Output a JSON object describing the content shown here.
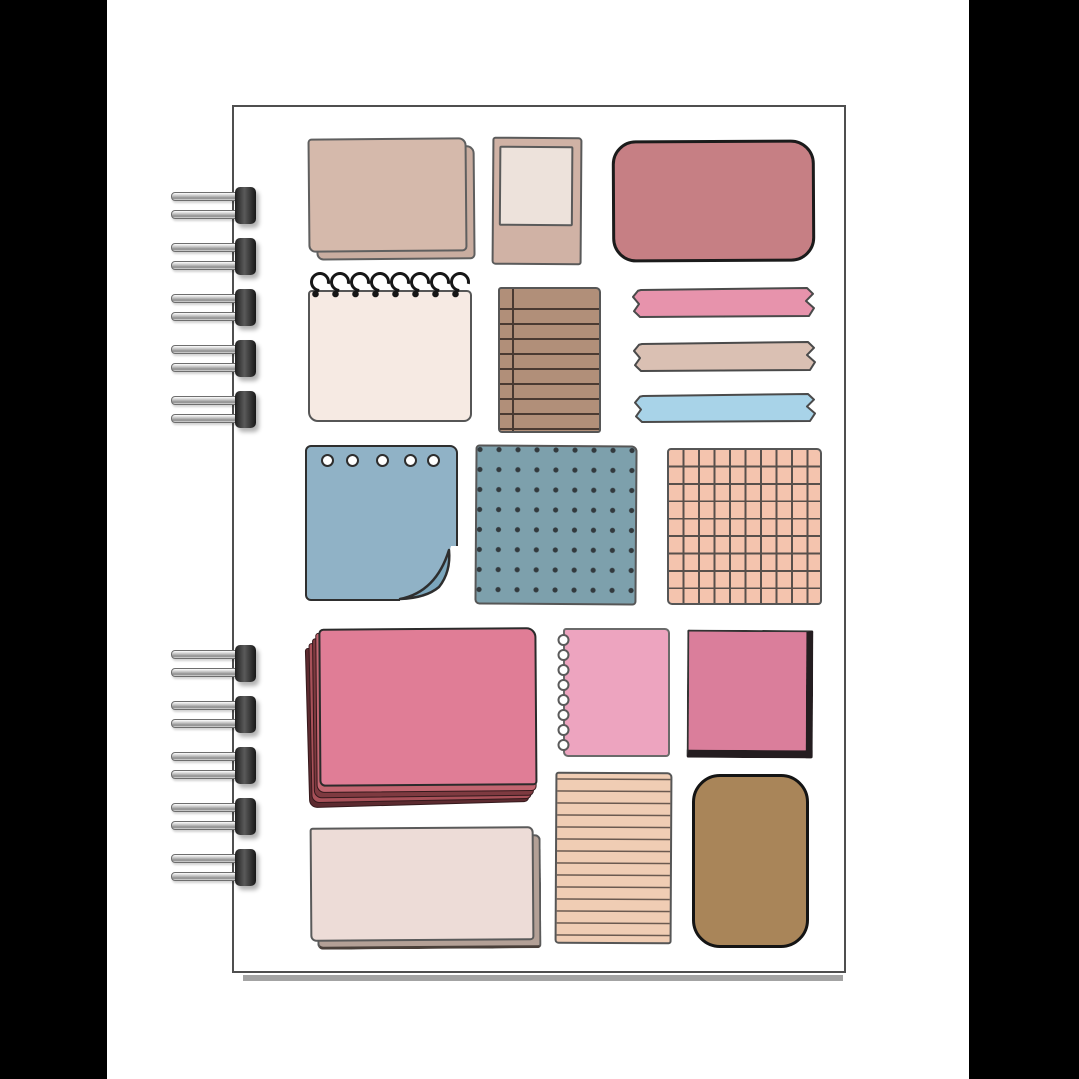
{
  "scene": {
    "subject": "spiral-bound notebook cover decorated with hand-drawn paper scraps, sticky notes and washi-tape stickers"
  },
  "canvas": {
    "width": 1079,
    "height": 1079,
    "background": "#ffffff"
  },
  "side_bars": {
    "color": "#000000",
    "left_x": 0,
    "left_width": 107,
    "right_x": 969,
    "right_width": 110
  },
  "cover": {
    "x": 232,
    "y": 105,
    "width": 614,
    "height": 868,
    "fill": "#ffffff",
    "border_color": "#4f4f4f",
    "shadow": {
      "x": 243,
      "y": 975,
      "width": 600,
      "height": 6,
      "color": "#a3a3a3"
    }
  },
  "binding": {
    "x": 171,
    "coil_width": 88,
    "top_group_centers_y": [
      205,
      256,
      307,
      358,
      409
    ],
    "bottom_group_centers_y": [
      663,
      714,
      765,
      816,
      867
    ],
    "metal_light": "#f4f4f4",
    "metal_dark": "#5e5e5e",
    "cap_color": "#2c2c2c"
  },
  "stickers": [
    {
      "name": "tan-stacked-note",
      "type": "stacked",
      "x": 308,
      "y": 138,
      "w": 159,
      "h": 114,
      "fill": "#d5b9ab",
      "back": "#c9ada0",
      "outline": "#5f5f5f",
      "dx": 8,
      "dy": 8,
      "tilt": -0.5,
      "radius": "4px 8px 5px 7px"
    },
    {
      "name": "polaroid-frame",
      "type": "polaroid",
      "x": 492,
      "y": 137,
      "w": 90,
      "h": 128,
      "frame": "#d0b2a5",
      "photo": "#ede2db",
      "outline": "#5a5a5a",
      "tilt": 0.4
    },
    {
      "name": "rose-rounded-card",
      "type": "card",
      "x": 612,
      "y": 140,
      "w": 203,
      "h": 122,
      "fill": "#c67f84",
      "outline": "#1b1b1b",
      "bw": 3,
      "radius": 24,
      "tilt": -0.3
    },
    {
      "name": "spiral-notepad",
      "type": "notepad",
      "x": 306,
      "y": 270,
      "w": 168,
      "h": 152,
      "fill": "#f6eae3",
      "outline": "#565656",
      "loop_color": "#161616",
      "loops": 8,
      "tilt": 0
    },
    {
      "name": "brown-lined-note",
      "type": "hlines",
      "x": 498,
      "y": 287,
      "w": 103,
      "h": 146,
      "fill": "#b18f79",
      "line": "#4a3a32",
      "gap": 15,
      "lw": 2,
      "margin": 12,
      "outline": "#565656",
      "tilt": 0
    },
    {
      "name": "washi-tape-pink",
      "type": "tape",
      "x": 630,
      "y": 287,
      "w": 187,
      "h": 31,
      "fill": "#e793ac",
      "outline": "#4a4a4a"
    },
    {
      "name": "washi-tape-beige",
      "type": "tape",
      "x": 631,
      "y": 341,
      "w": 187,
      "h": 31,
      "fill": "#dac0b3",
      "outline": "#4a4a4a"
    },
    {
      "name": "washi-tape-blue",
      "type": "tape",
      "x": 632,
      "y": 393,
      "w": 186,
      "h": 30,
      "fill": "#a8d3e8",
      "outline": "#4a4a4a"
    },
    {
      "name": "blue-punched-note",
      "type": "punched",
      "x": 305,
      "y": 445,
      "w": 153,
      "h": 156,
      "fill": "#90b2c6",
      "curl": "#7ba6bc",
      "outline": "#2e2e2e",
      "holes": 5,
      "tilt": 0
    },
    {
      "name": "blue-dotted-note",
      "type": "dots",
      "x": 475,
      "y": 445,
      "w": 162,
      "h": 160,
      "fill": "#7da0ac",
      "dot": "#32393d",
      "gap": 19,
      "outline": "#565656",
      "tilt": 0.4
    },
    {
      "name": "peach-grid-note",
      "type": "grid",
      "x": 667,
      "y": 448,
      "w": 155,
      "h": 157,
      "fill": "#f4c4ae",
      "line": "#58504c",
      "cw": 15.5,
      "ch": 17.4,
      "outline": "#565656",
      "tilt": 0
    },
    {
      "name": "pink-paper-stack",
      "type": "stack",
      "x": 307,
      "y": 628,
      "w": 232,
      "h": 181,
      "top": "#e07d96",
      "outline": "#2b2b2b",
      "layers": [
        "#5c2a2f",
        "#a85159",
        "#7e3a40",
        "#c26570"
      ],
      "tilt": -0.4
    },
    {
      "name": "pink-torn-note",
      "type": "torn",
      "x": 553,
      "y": 628,
      "w": 117,
      "h": 129,
      "fill": "#eda4bf",
      "outline": "#6a6a6a",
      "rings": 8,
      "ring_fill": "#ffffff",
      "tilt": 0
    },
    {
      "name": "pink-stitched-note",
      "type": "stitched",
      "x": 687,
      "y": 630,
      "w": 126,
      "h": 128,
      "fill": "#da7e9b",
      "edge": "#241d20",
      "outline": "#333333",
      "tilt": 0.3
    },
    {
      "name": "cream-wide-note",
      "type": "stacked",
      "x": 310,
      "y": 827,
      "w": 224,
      "h": 114,
      "fill": "#eddcd7",
      "back": "#b3a096",
      "back_edge": "#4a403a",
      "outline": "#5a5a5a",
      "dx": 7,
      "dy": 8,
      "tilt": -0.4,
      "radius": "3px 6px 4px 6px"
    },
    {
      "name": "peach-lined-note",
      "type": "hlines",
      "x": 555,
      "y": 772,
      "w": 117,
      "h": 172,
      "fill": "#f0cdb4",
      "line": "#6b5a50",
      "gap": 12,
      "lw": 1.7,
      "margin": 0,
      "outline": "#565656",
      "tilt": 0.3
    },
    {
      "name": "brown-rounded-card",
      "type": "card",
      "x": 692,
      "y": 774,
      "w": 117,
      "h": 174,
      "fill": "#a98559",
      "outline": "#141414",
      "bw": 3,
      "radius": 28,
      "tilt": 0
    }
  ]
}
